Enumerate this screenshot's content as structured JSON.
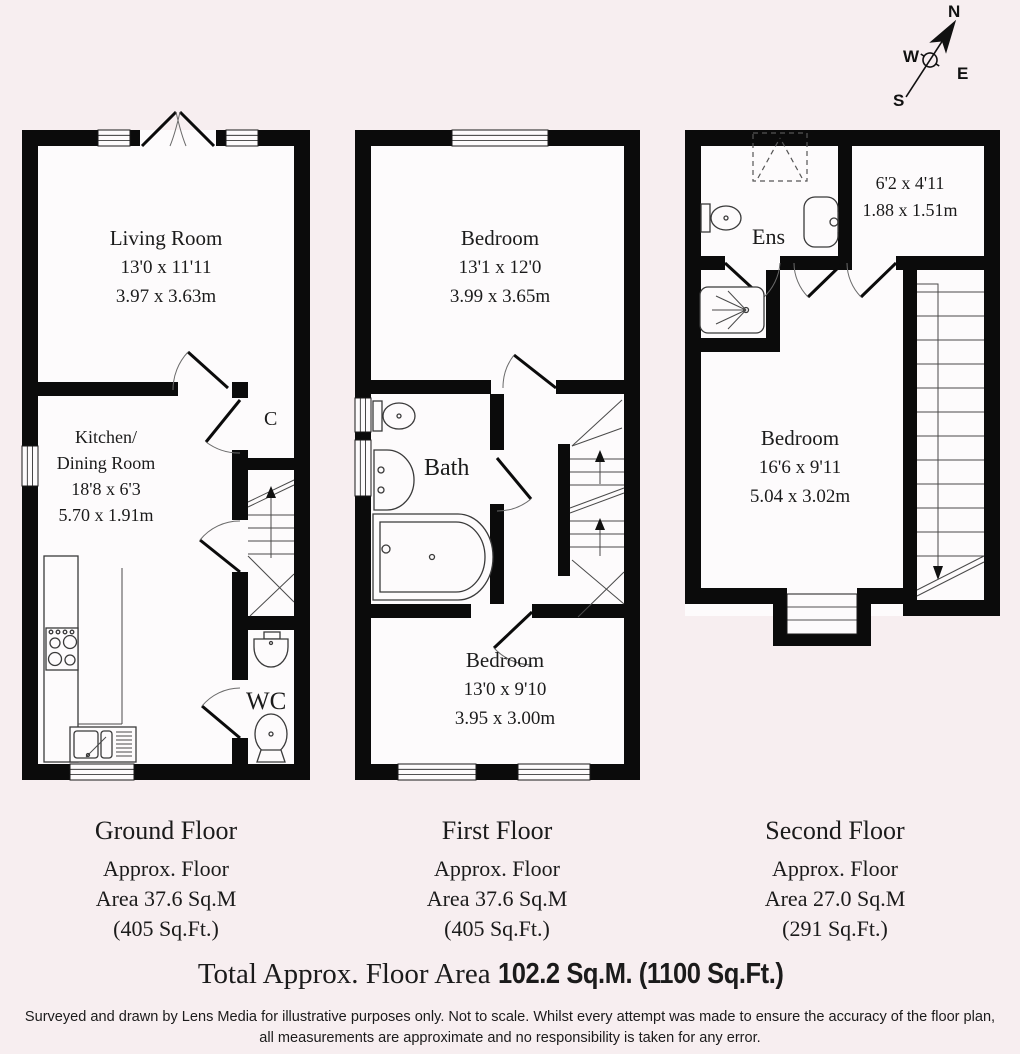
{
  "compass": {
    "north": "N",
    "west": "W",
    "east": "E",
    "south": "S"
  },
  "ground_floor": {
    "living_room": {
      "name": "Living Room",
      "imperial": "13'0 x 11'11",
      "metric": "3.97 x 3.63m"
    },
    "kitchen": {
      "name_line1": "Kitchen/",
      "name_line2": "Dining Room",
      "imperial": "18'8 x 6'3",
      "metric": "5.70 x 1.91m"
    },
    "cupboard_label": "C",
    "wc_label": "WC",
    "caption": {
      "title": "Ground Floor",
      "line1": "Approx. Floor",
      "line2": "Area 37.6 Sq.M",
      "line3": "(405 Sq.Ft.)"
    }
  },
  "first_floor": {
    "bedroom_front": {
      "name": "Bedroom",
      "imperial": "13'1 x 12'0",
      "metric": "3.99 x 3.65m"
    },
    "bath_label": "Bath",
    "bedroom_back": {
      "name": "Bedroom",
      "imperial": "13'0 x 9'10",
      "metric": "3.95 x 3.00m"
    },
    "caption": {
      "title": "First Floor",
      "line1": "Approx. Floor",
      "line2": "Area 37.6 Sq.M",
      "line3": "(405 Sq.Ft.)"
    }
  },
  "second_floor": {
    "ensuite_label": "Ens",
    "store_room": {
      "imperial": "6'2 x 4'11",
      "metric": "1.88 x 1.51m"
    },
    "bedroom": {
      "name": "Bedroom",
      "imperial": "16'6 x 9'11",
      "metric": "5.04 x 3.02m"
    },
    "caption": {
      "title": "Second Floor",
      "line1": "Approx. Floor",
      "line2": "Area 27.0 Sq.M",
      "line3": "(291 Sq.Ft.)"
    }
  },
  "total_area": {
    "prefix": "Total Approx. Floor Area ",
    "value": "102.2 Sq.M. (1100 Sq.Ft.)"
  },
  "disclaimer": {
    "line1": "Surveyed and drawn by Lens Media for illustrative purposes only. Not to scale. Whilst every attempt was made to ensure the accuracy of the floor plan,",
    "line2": "all measurements are approximate and no responsibility is taken for any error."
  },
  "colors": {
    "background": "#f7eef0",
    "wall": "#0b0b0b",
    "room": "#fdfbfc"
  }
}
